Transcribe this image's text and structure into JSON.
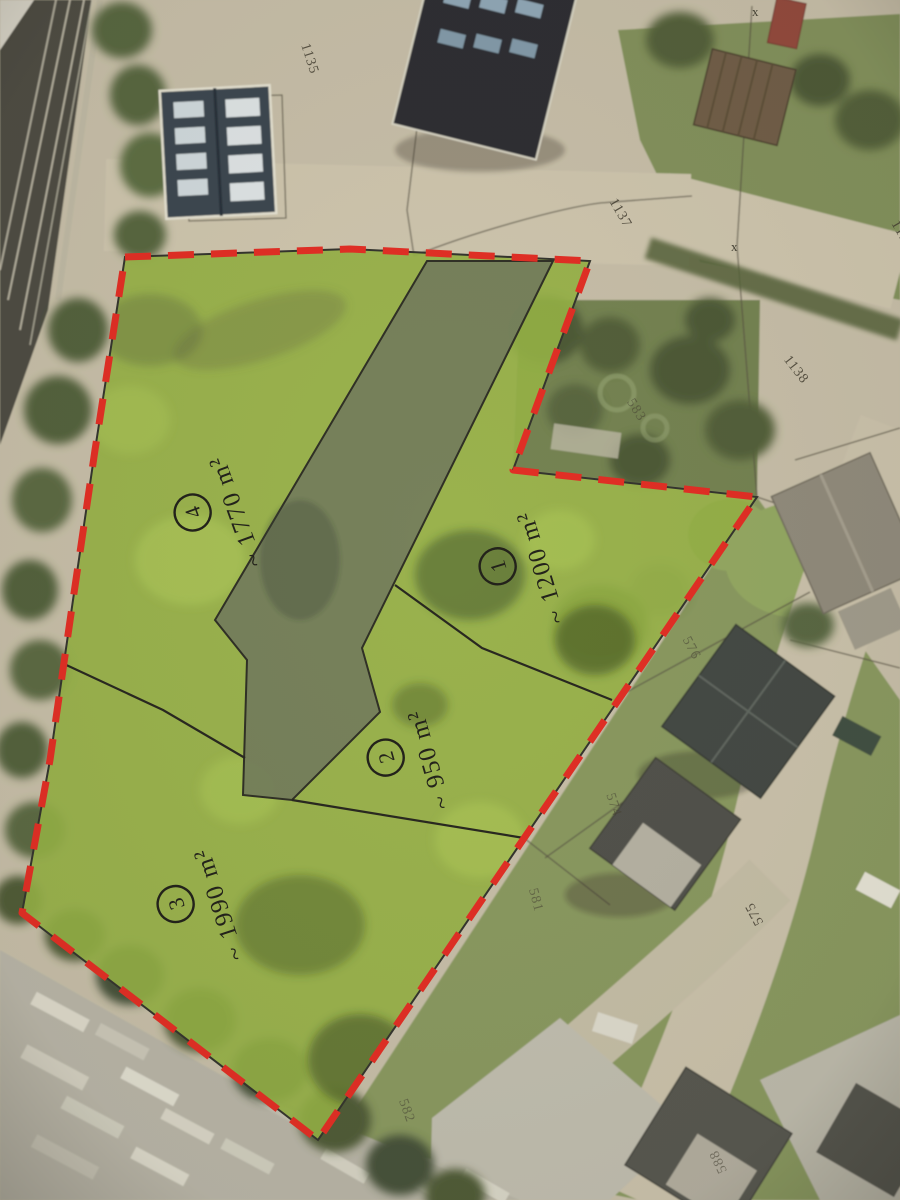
{
  "map": {
    "parcels": [
      {
        "number": "1",
        "area": "~ 1200 m²"
      },
      {
        "number": "2",
        "area": "~ 950 m²"
      },
      {
        "number": "3",
        "area": "~ 1990 m²"
      },
      {
        "number": "4",
        "area": "~ 1770 m²"
      }
    ],
    "cadastral_labels": [
      {
        "text": "1135"
      },
      {
        "text": "1137"
      },
      {
        "text": "1137"
      },
      {
        "text": "1138"
      },
      {
        "text": "583"
      },
      {
        "text": "576"
      },
      {
        "text": "574"
      },
      {
        "text": "581"
      },
      {
        "text": "575"
      },
      {
        "text": "582"
      },
      {
        "text": "588"
      }
    ],
    "boundary_marks": [
      {
        "text": "x"
      },
      {
        "text": "x"
      }
    ],
    "colors": {
      "boundary_red": "#e2241b",
      "parcel_green": "#90ae3e",
      "corridor_grey": "#6f7a55",
      "label_ink": "#171610"
    }
  }
}
